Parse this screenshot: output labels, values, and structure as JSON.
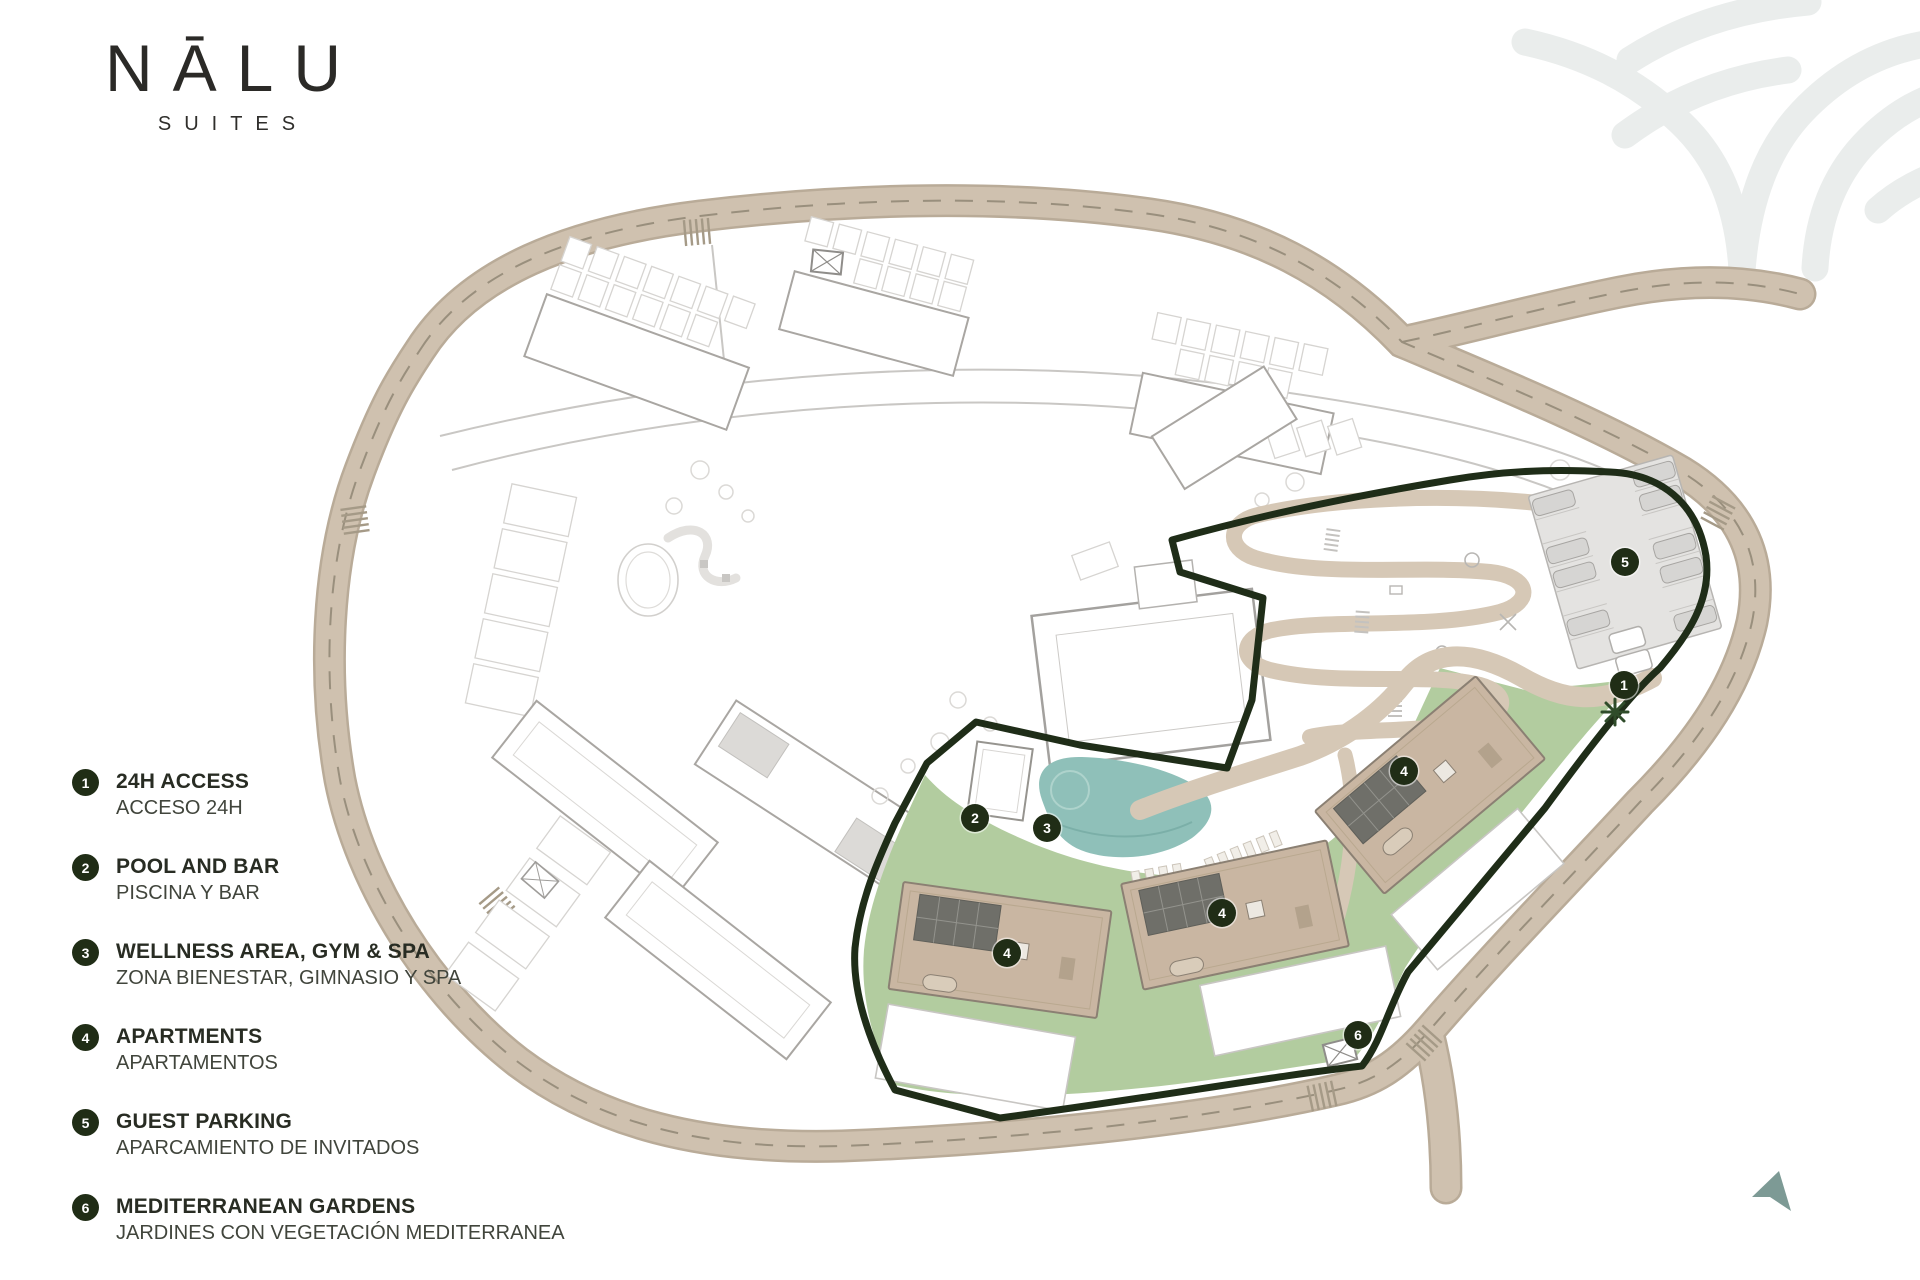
{
  "brand": {
    "name": "NĀLU",
    "tagline": "SUITES"
  },
  "legend": {
    "items": [
      {
        "number": "1",
        "title": "24H ACCESS",
        "subtitle": "ACCESO 24H"
      },
      {
        "number": "2",
        "title": "POOL AND BAR",
        "subtitle": "PISCINA Y BAR"
      },
      {
        "number": "3",
        "title": "WELLNESS AREA, GYM & SPA",
        "subtitle": "ZONA BIENESTAR, GIMNASIO Y SPA"
      },
      {
        "number": "4",
        "title": "APARTMENTS",
        "subtitle": "APARTAMENTOS"
      },
      {
        "number": "5",
        "title": "GUEST PARKING",
        "subtitle": "APARCAMIENTO DE INVITADOS"
      },
      {
        "number": "6",
        "title": "MEDITERRANEAN GARDENS",
        "subtitle": "JARDINES CON VEGETACIÓN MEDITERRANEA"
      }
    ]
  },
  "map": {
    "markers": [
      {
        "label": "1",
        "name": "24h-access",
        "x": 1624,
        "y": 685
      },
      {
        "label": "2",
        "name": "pool-and-bar",
        "x": 975,
        "y": 818
      },
      {
        "label": "3",
        "name": "wellness-gym-spa",
        "x": 1047,
        "y": 828
      },
      {
        "label": "4",
        "name": "apartments-west",
        "x": 1007,
        "y": 953
      },
      {
        "label": "4",
        "name": "apartments-central",
        "x": 1222,
        "y": 913
      },
      {
        "label": "4",
        "name": "apartments-east",
        "x": 1404,
        "y": 771
      },
      {
        "label": "5",
        "name": "guest-parking",
        "x": 1625,
        "y": 562
      },
      {
        "label": "6",
        "name": "mediterranean-gardens",
        "x": 1358,
        "y": 1035
      }
    ],
    "colors": {
      "boundary": "#1f2d18",
      "marker": "#202d16",
      "lawn": "#b2cc9f",
      "pool": "#8fc0b9",
      "road": "#cfc1af",
      "building": "#c9b6a2",
      "parking": "#e4e3e1",
      "arrow": "#7d9a95",
      "watermark": "#eaedec"
    }
  }
}
